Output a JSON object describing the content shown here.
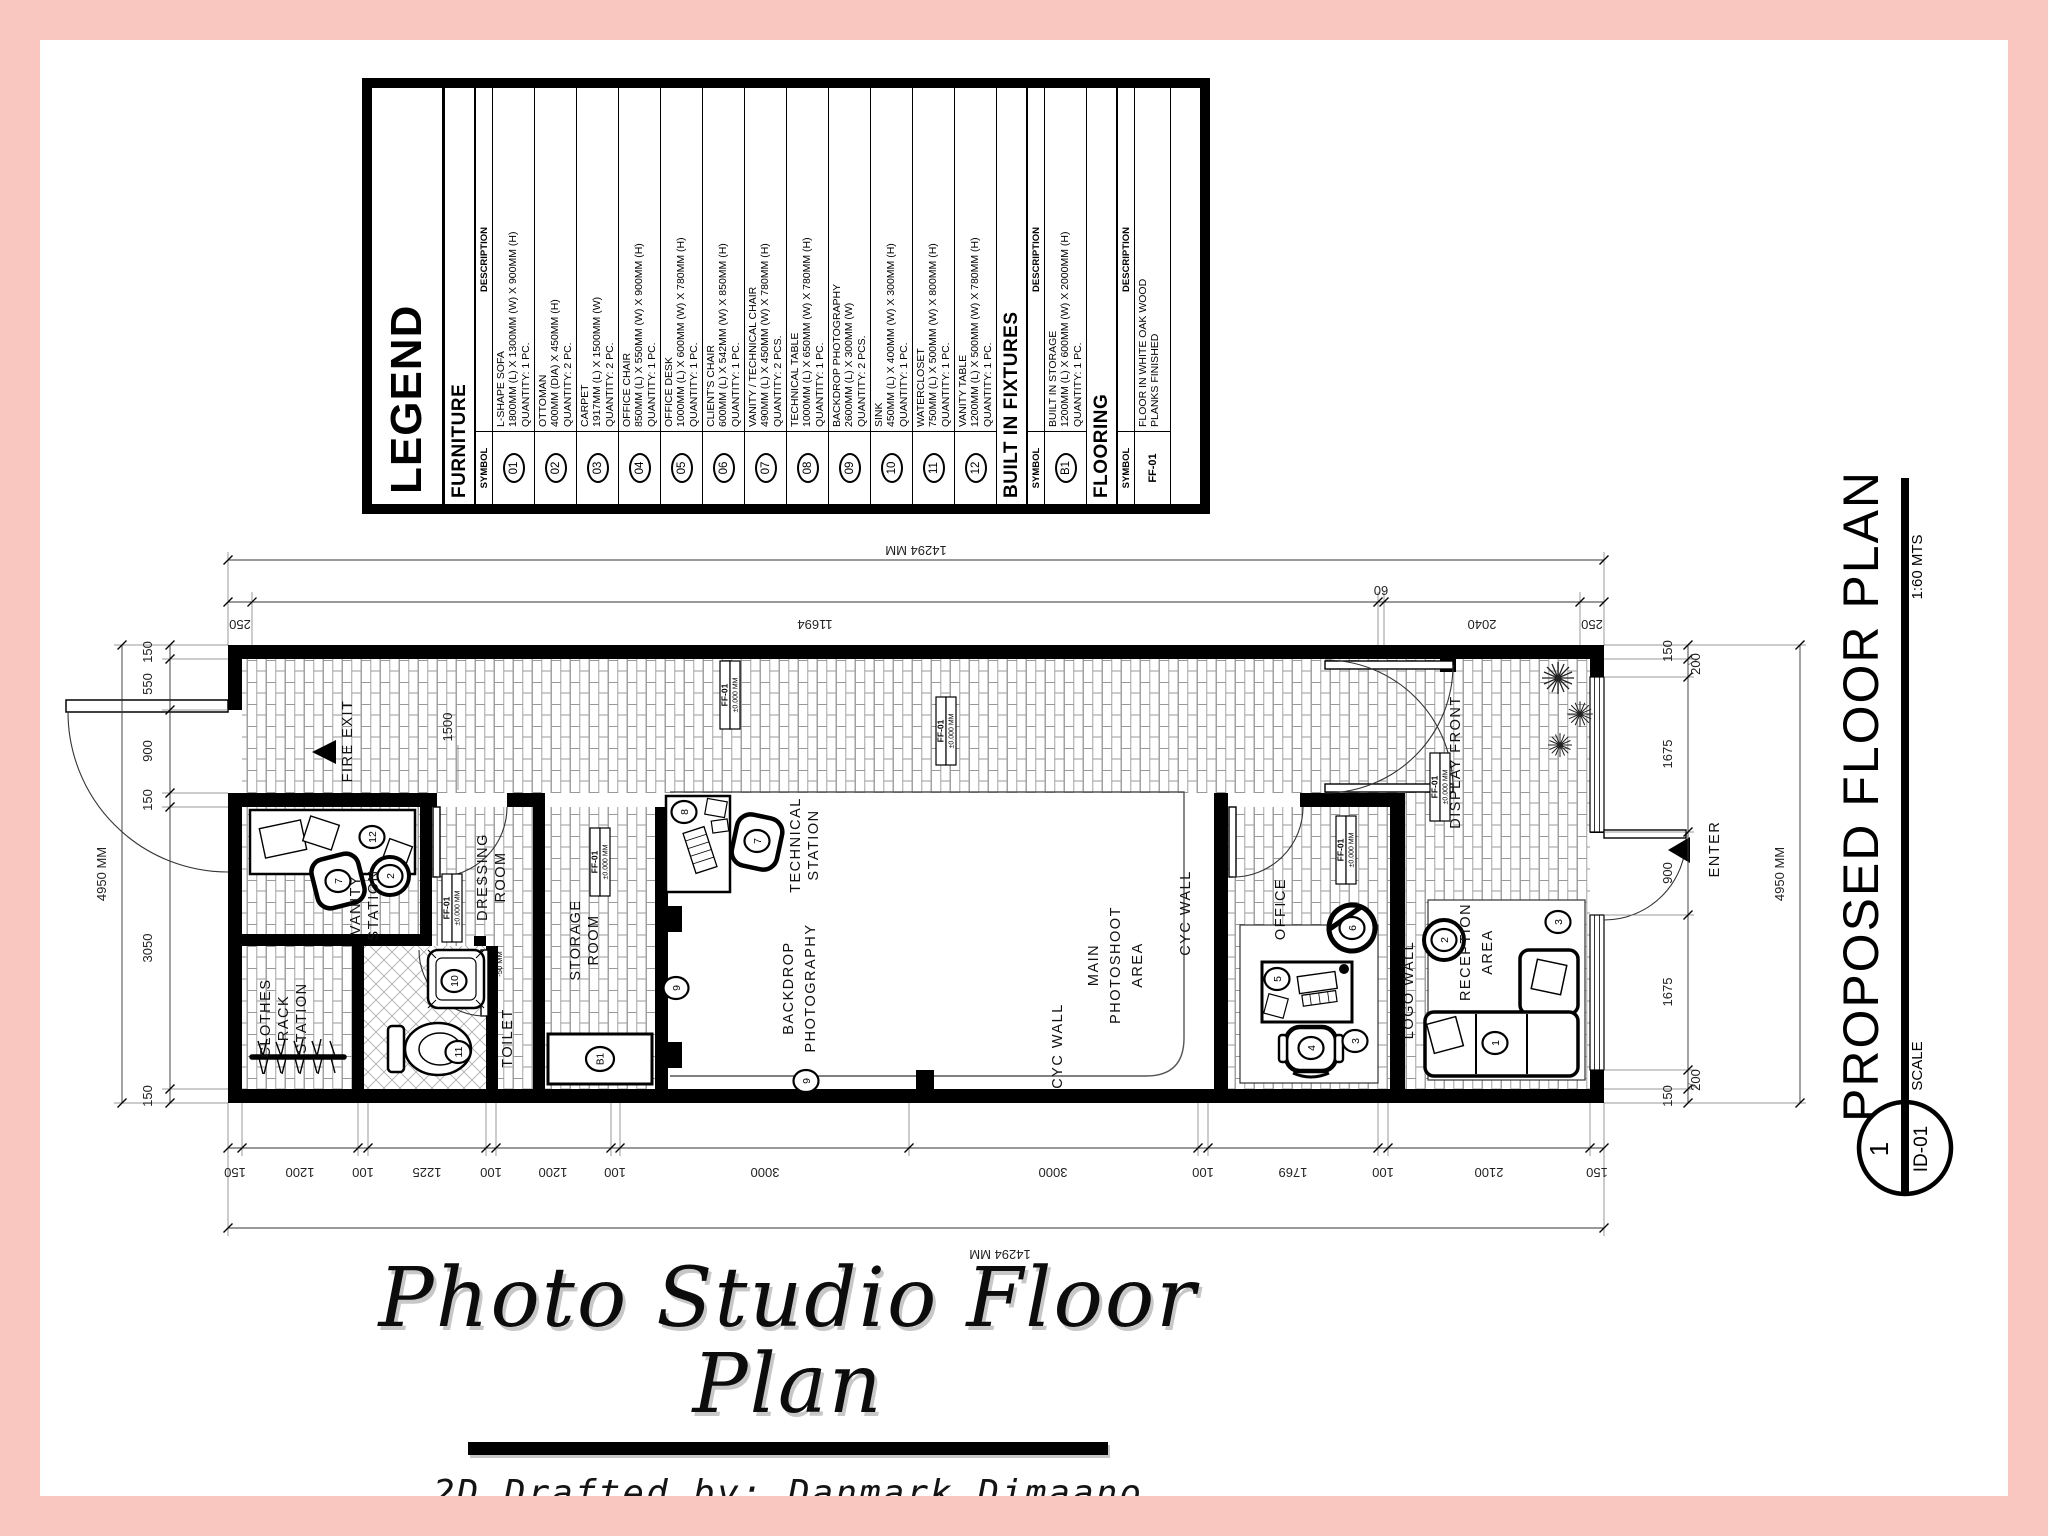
{
  "legend": {
    "title": "LEGEND",
    "sections": [
      {
        "title": "FURNITURE",
        "symbol_header": "SYMBOL",
        "description_header": "DESCRIPTION",
        "rows": [
          {
            "symbol": "01",
            "name": "L-SHAPE SOFA",
            "dims": "1800MM (L) X 1300MM (W) X 900MM (H)",
            "qty": "QUANTITY: 1 PC."
          },
          {
            "symbol": "02",
            "name": "OTTOMAN",
            "dims": "400MM (DIA) X 450MM (H)",
            "qty": "QUANTITY: 2 PC."
          },
          {
            "symbol": "03",
            "name": "CARPET",
            "dims": "1917MM (L) X 1500MM (W)",
            "qty": "QUANTITY: 2 PC."
          },
          {
            "symbol": "04",
            "name": "OFFICE CHAIR",
            "dims": "850MM (L) X 550MM (W) X 900MM (H)",
            "qty": "QUANTITY: 1 PC."
          },
          {
            "symbol": "05",
            "name": "OFFICE DESK",
            "dims": "1000MM (L) X 600MM (W) X 780MM (H)",
            "qty": "QUANTITY: 1 PC."
          },
          {
            "symbol": "06",
            "name": "CLIENT'S CHAIR",
            "dims": "600MM (L) X 542MM (W) X 850MM (H)",
            "qty": "QUANTITY: 1 PC."
          },
          {
            "symbol": "07",
            "name": "VANITY / TECHNICAL CHAIR",
            "dims": "490MM (L) X 450MM (W) X 780MM (H)",
            "qty": "QUANTITY: 2 PCS."
          },
          {
            "symbol": "08",
            "name": "TECHNICAL TABLE",
            "dims": "1000MM (L) X 650MM (W) X 780MM (H)",
            "qty": "QUANTITY: 1 PC."
          },
          {
            "symbol": "09",
            "name": "BACKDROP PHOTOGRAPHY",
            "dims": "2600MM (L) X 300MM (W)",
            "qty": "QUANTITY: 2 PCS."
          },
          {
            "symbol": "10",
            "name": "SINK",
            "dims": "450MM (L) X 400MM (W) X 300MM (H)",
            "qty": "QUANTITY: 1 PC."
          },
          {
            "symbol": "11",
            "name": "WATERCLOSET",
            "dims": "750MM (L) X 500MM (W) X 800MM (H)",
            "qty": "QUANTITY: 1 PC."
          },
          {
            "symbol": "12",
            "name": "VANITY TABLE",
            "dims": "1200MM (L) X 500MM (W) X 780MM (H)",
            "qty": "QUANTITY: 1 PC."
          }
        ]
      },
      {
        "title": "BUILT IN FIXTURES",
        "symbol_header": "SYMBOL",
        "description_header": "DESCRIPTION",
        "rows": [
          {
            "symbol": "B1",
            "name": "BUILT IN STORAGE",
            "dims": "1200MM (L) X 600MM (W) X 2000MM (H)",
            "qty": "QUANTITY: 1 PC."
          }
        ]
      },
      {
        "title": "FLOORING",
        "symbol_header": "SYMBOL",
        "description_header": "DESCRIPTION",
        "rows": [
          {
            "symbol": "FF-01",
            "name": "FLOOR IN WHITE OAK WOOD",
            "dims": "PLANKS FINISHED",
            "qty": ""
          }
        ]
      }
    ]
  },
  "plan": {
    "labels": {
      "fire_exit": "FIRE EXIT",
      "dressing": [
        "DRESSING",
        "ROOM"
      ],
      "vanity": [
        "VANITY",
        "STATION"
      ],
      "clothes": [
        "CLOTHES",
        "RACK",
        "STATION"
      ],
      "toilet": "TOILET",
      "storage": [
        "STORAGE",
        "ROOM"
      ],
      "technical": [
        "TECHNICAL",
        "STATION"
      ],
      "backdrop": [
        "BACKDROP",
        "PHOTOGRAPHY"
      ],
      "main": [
        "MAIN",
        "PHOTOSHOOT",
        "AREA"
      ],
      "cyc": "CYC WALL",
      "office": "OFFICE",
      "logo": "LOGO WALL",
      "reception": [
        "RECEPTION",
        "AREA"
      ],
      "display": "DISPLAY FRONT",
      "enter": "ENTER"
    },
    "dims": {
      "top_overall": "14294 MM",
      "bottom_overall": "14294 MM",
      "left_overall": "4950 MM",
      "right_overall": "4950 MM",
      "top_chain": [
        "250",
        "11694",
        "60",
        "2040",
        "250"
      ],
      "bottom_chain": [
        "150",
        "1200",
        "100",
        "1225",
        "100",
        "1200",
        "100",
        "3000",
        "3000",
        "100",
        "1769",
        "100",
        "2100",
        "150"
      ],
      "left_chain": [
        "150",
        "550",
        "900",
        "150",
        "3050",
        "150"
      ],
      "right_chain": [
        "150",
        "200",
        "1675",
        "900",
        "1675",
        "200",
        "150"
      ],
      "interior_corridor": "1500"
    },
    "tags": {
      "code": "FF-01",
      "level": "±0.000 MM",
      "toilet_level": "-50 MM"
    },
    "symbols": {
      "vanity_table": "12",
      "vanity_chair": "7",
      "vanity_ottoman": "2",
      "sink": "10",
      "watercloset": "11",
      "built_in_storage": "B1",
      "technical_table": "8",
      "technical_chair": "7",
      "backdrop_left": "9",
      "backdrop_bottom": "9",
      "office_desk": "5",
      "office_chair": "4",
      "client_chair": "6",
      "office_carpet": "3",
      "sofa": "1",
      "reception_ottoman": "2",
      "reception_carpet": "3"
    }
  },
  "titleblock": {
    "title": "PROPOSED FLOOR PLAN",
    "scale_label": "SCALE",
    "scale_value": "1:60 MTS",
    "detail_number": "1",
    "sheet_id": "ID-01"
  },
  "footer": {
    "title": "Photo Studio Floor Plan",
    "credit": "2D Drafted by: Danmark Dimaano"
  }
}
